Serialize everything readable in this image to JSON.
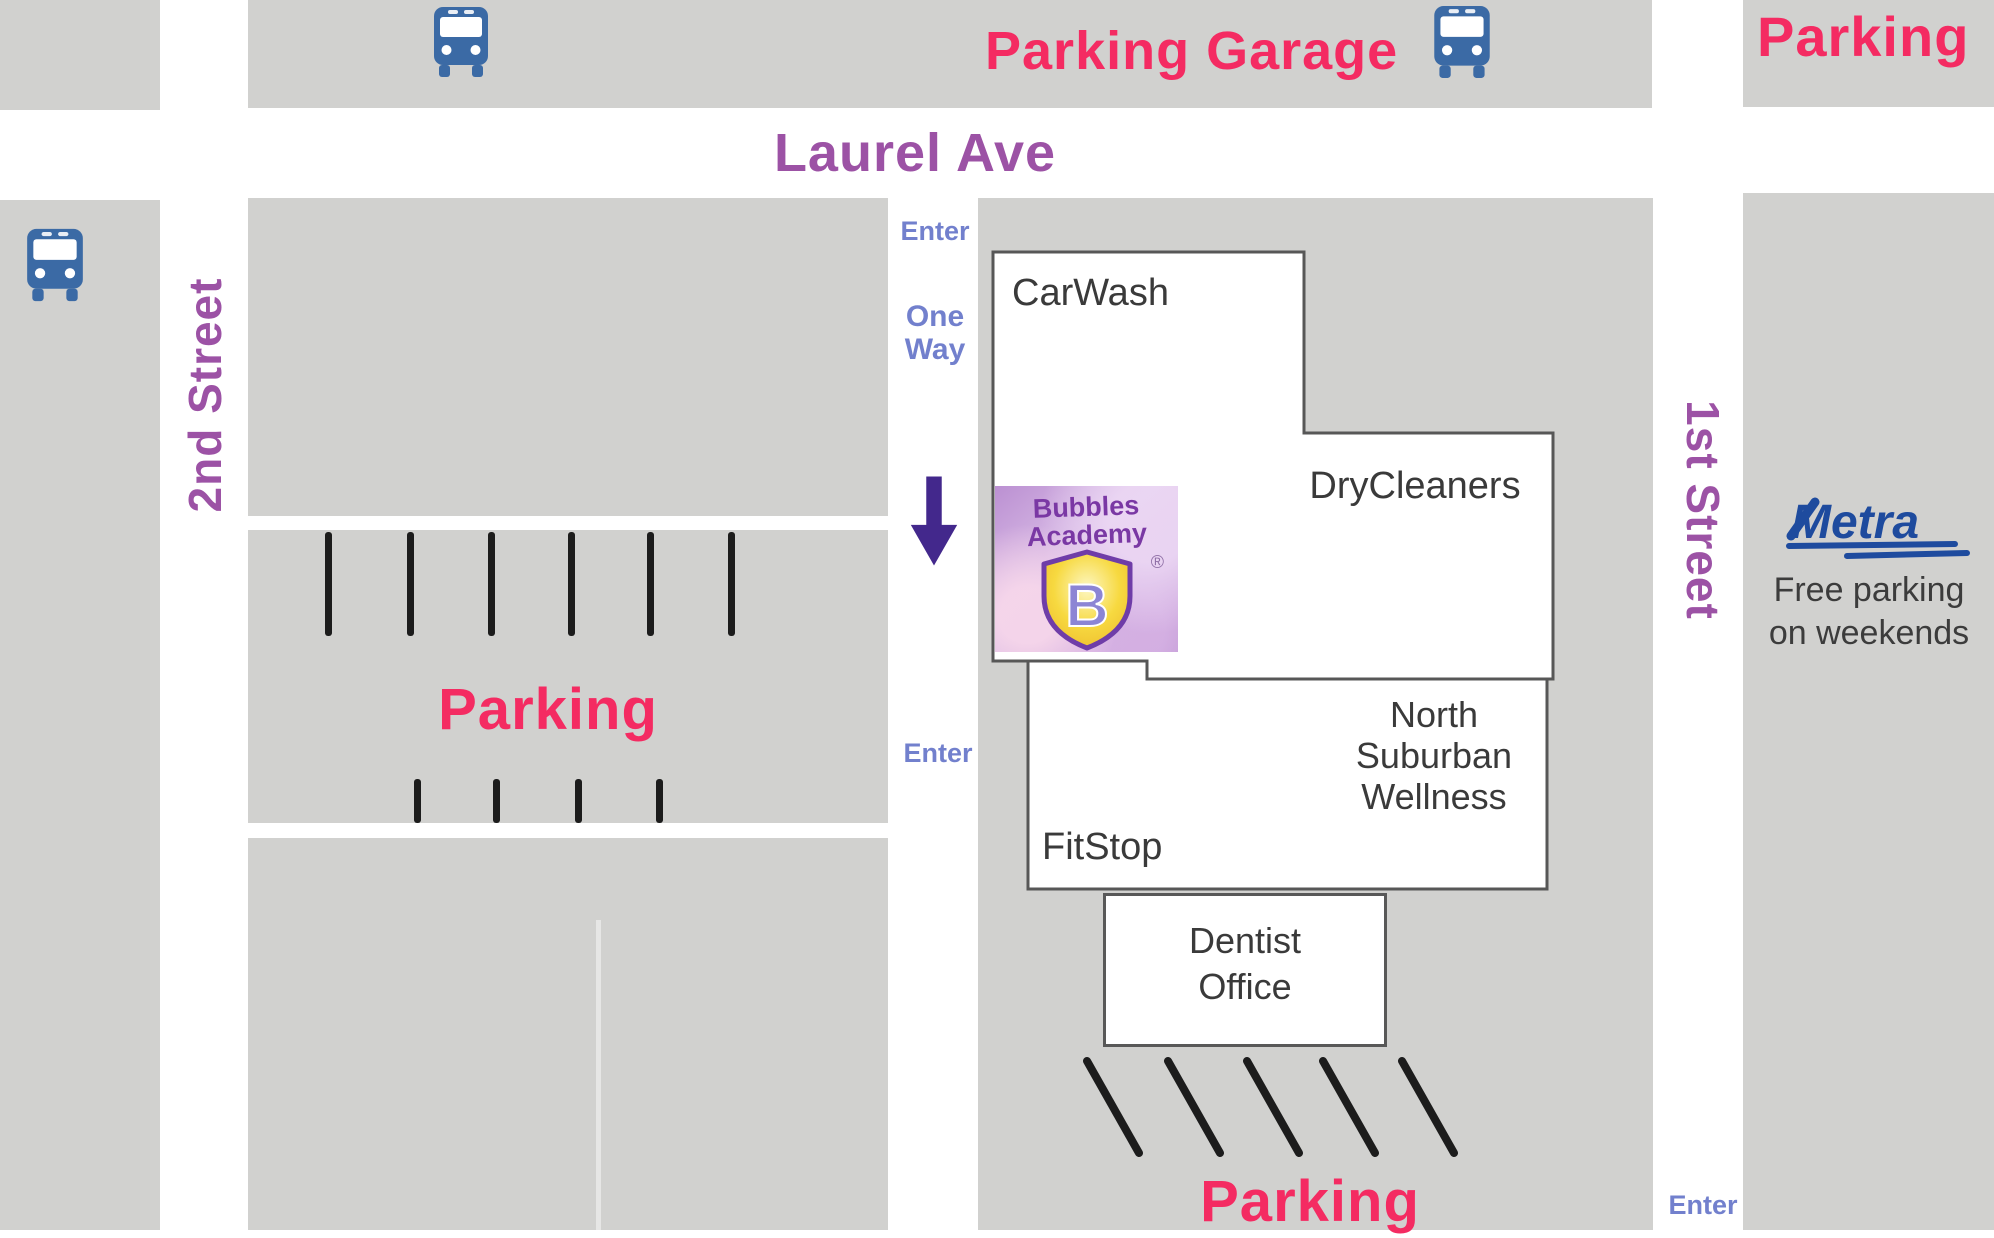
{
  "streets": {
    "laurel_ave": "Laurel Ave",
    "second_street": "2nd Street",
    "first_street": "1st Street"
  },
  "signs": {
    "parking_garage": "Parking Garage",
    "parking_north_east": "Parking",
    "parking_west_lot": "Parking",
    "parking_south_lot": "Parking",
    "one_way": {
      "line1": "One",
      "line2": "Way"
    },
    "enter_laurel": "Enter",
    "enter_west_lot": "Enter",
    "enter_south": "Enter"
  },
  "buildings": {
    "carwash": "CarWash",
    "drycleaners": "DryCleaners",
    "fitstop": "FitStop",
    "north_suburban_wellness": {
      "line1": "North",
      "line2": "Suburban",
      "line3": "Wellness"
    },
    "dentist_office": {
      "line1": "Dentist",
      "line2": "Office"
    }
  },
  "logo": {
    "name_line1": "Bubbles",
    "name_line2": "Academy",
    "registered_mark": "®",
    "monogram": "B"
  },
  "transit": {
    "metra": "Metra",
    "note_line1": "Free parking",
    "note_line2": "on weekends"
  },
  "icons": {
    "bus": "bus-icon",
    "one_way_arrow": "arrow-down-icon",
    "logo_shield": "shield-badge-icon"
  },
  "colors": {
    "block_gray": "#d1d1cf",
    "street_white": "#ffffff",
    "street_label_purple": "#9c52a5",
    "parking_pink": "#f42b62",
    "wayfinding_periwinkle": "#7280cd",
    "one_way_arrow_purple": "#43288c",
    "bus_blue": "#3b6aa5",
    "metra_blue": "#1e4b9e",
    "building_outline": "#575757",
    "parking_stripe_black": "#1c1c1c"
  }
}
